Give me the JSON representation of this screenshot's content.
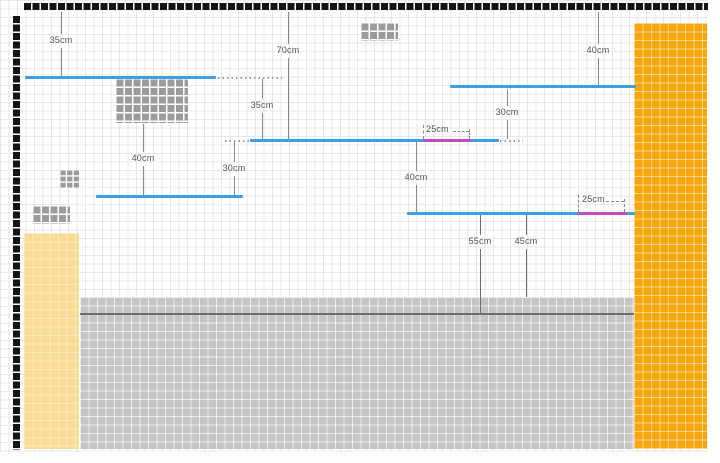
{
  "measurements": {
    "m_35_top_left": {
      "label": "35cm"
    },
    "m_70_top_center": {
      "label": "70cm"
    },
    "m_40_top_right": {
      "label": "40cm"
    },
    "m_35_between_shelves": {
      "label": "35cm"
    },
    "m_30_right_gap": {
      "label": "30cm"
    },
    "m_40_block_to_shelf": {
      "label": "40cm"
    },
    "m_30_center_gap": {
      "label": "30cm"
    },
    "m_40_center_gap": {
      "label": "40cm"
    },
    "m_55_to_floor_line": {
      "label": "55cm"
    },
    "m_45_to_floor": {
      "label": "45cm"
    },
    "b_25_shelf2": {
      "label": "25cm"
    },
    "b_25_shelf4": {
      "label": "25cm"
    }
  },
  "colors": {
    "shelf_blue": "#3E9FE3",
    "accent_magenta": "#C24AC2",
    "wall_orange": "#F7A70B",
    "column_yellow": "#F8DC96",
    "floor_gray": "#C5C5C5",
    "block_gray": "#9B9B9B",
    "border_black": "#141414",
    "dimension_gray": "#8A8A8A"
  }
}
